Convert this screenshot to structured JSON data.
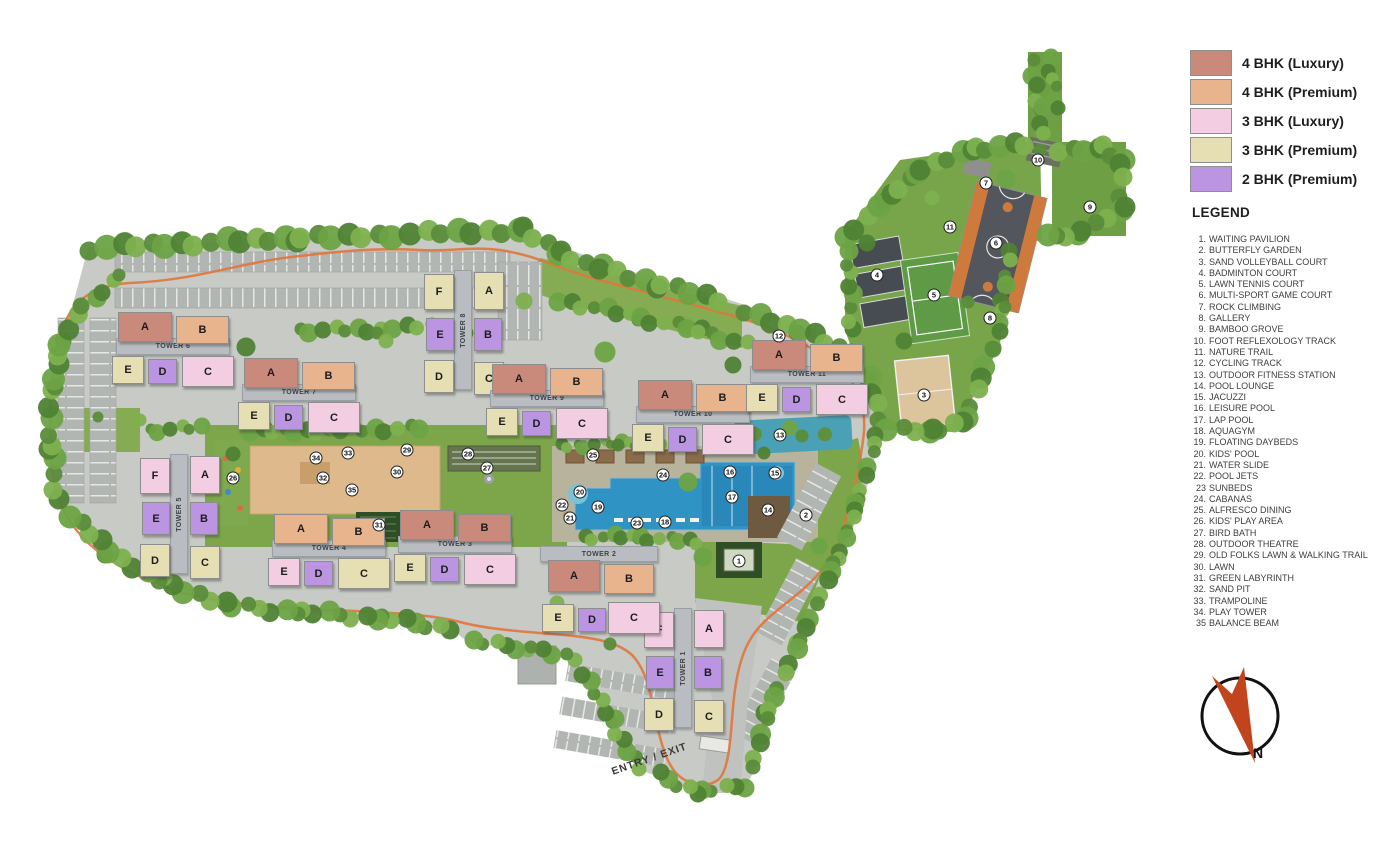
{
  "palette": {
    "4L": "#c98a7b",
    "4P": "#e8b48e",
    "3L": "#f3cde1",
    "3P": "#e5dfb3",
    "2P": "#bb95e2",
    "accent_trail": "#e0763c",
    "compass_needle": "#c2441c"
  },
  "key": {
    "items": [
      {
        "label": "4 BHK (Luxury)",
        "type": "4L"
      },
      {
        "label": "4 BHK (Premium)",
        "type": "4P"
      },
      {
        "label": "3 BHK (Luxury)",
        "type": "3L"
      },
      {
        "label": "3 BHK (Premium)",
        "type": "3P"
      },
      {
        "label": "2 BHK (Premium)",
        "type": "2P"
      }
    ]
  },
  "legend": {
    "title": "LEGEND",
    "items": [
      {
        "n": "1.",
        "label": "WAITING PAVILION"
      },
      {
        "n": "2.",
        "label": "BUTTERFLY GARDEN"
      },
      {
        "n": "3.",
        "label": "SAND VOLLEYBALL COURT"
      },
      {
        "n": "4.",
        "label": "BADMINTON COURT"
      },
      {
        "n": "5.",
        "label": "LAWN TENNIS COURT"
      },
      {
        "n": "6.",
        "label": "MULTI-SPORT GAME COURT"
      },
      {
        "n": "7.",
        "label": "ROCK CLIMBING"
      },
      {
        "n": "8.",
        "label": "GALLERY"
      },
      {
        "n": "9.",
        "label": "BAMBOO GROVE"
      },
      {
        "n": "10.",
        "label": "FOOT REFLEXOLOGY TRACK"
      },
      {
        "n": "11.",
        "label": "NATURE TRAIL"
      },
      {
        "n": "12.",
        "label": "CYCLING TRACK"
      },
      {
        "n": "13.",
        "label": "OUTDOOR FITNESS STATION"
      },
      {
        "n": "14.",
        "label": "POOL LOUNGE"
      },
      {
        "n": "15.",
        "label": "JACUZZI"
      },
      {
        "n": "16.",
        "label": "LEISURE POOL"
      },
      {
        "n": "17.",
        "label": "LAP POOL"
      },
      {
        "n": "18.",
        "label": "AQUAGYM"
      },
      {
        "n": "19.",
        "label": "FLOATING DAYBEDS"
      },
      {
        "n": "20.",
        "label": "KIDS' POOL"
      },
      {
        "n": "21.",
        "label": "WATER SLIDE"
      },
      {
        "n": "22.",
        "label": "POOL JETS"
      },
      {
        "n": "23",
        "label": "SUNBEDS"
      },
      {
        "n": "24.",
        "label": "CABANAS"
      },
      {
        "n": "25.",
        "label": "ALFRESCO DINING"
      },
      {
        "n": "26.",
        "label": "KIDS' PLAY AREA"
      },
      {
        "n": "27.",
        "label": "BIRD BATH"
      },
      {
        "n": "28.",
        "label": "OUTDOOR THEATRE"
      },
      {
        "n": "29.",
        "label": "OLD FOLKS LAWN & WALKING TRAIL"
      },
      {
        "n": "30.",
        "label": "LAWN"
      },
      {
        "n": "31.",
        "label": "GREEN LABYRINTH"
      },
      {
        "n": "32.",
        "label": "SAND PIT"
      },
      {
        "n": "33.",
        "label": "TRAMPOLINE"
      },
      {
        "n": "34.",
        "label": "PLAY TOWER"
      },
      {
        "n": "35",
        "label": "BALANCE BEAM"
      }
    ]
  },
  "towers": [
    {
      "name": "TOWER 1",
      "kind": "v",
      "x": 644,
      "y": 606,
      "blocks": [
        {
          "letter": "F",
          "type": "3L"
        },
        {
          "letter": "A",
          "type": "3L"
        },
        {
          "letter": "E",
          "type": "2P"
        },
        {
          "letter": "B",
          "type": "2P"
        },
        {
          "letter": "D",
          "type": "3P"
        },
        {
          "letter": "C",
          "type": "3P"
        }
      ]
    },
    {
      "name": "TOWER 2",
      "kind": "ht",
      "x": 540,
      "y": 546,
      "blocks": [
        {
          "letter": "A",
          "type": "4L"
        },
        {
          "letter": "B",
          "type": "4P"
        },
        {
          "letter": "E",
          "type": "3P"
        },
        {
          "letter": "D",
          "type": "2P"
        },
        {
          "letter": "C",
          "type": "3L"
        }
      ]
    },
    {
      "name": "TOWER 3",
      "kind": "h",
      "x": 394,
      "y": 510,
      "blocks": [
        {
          "letter": "A",
          "type": "4L"
        },
        {
          "letter": "B",
          "type": "4L"
        },
        {
          "letter": "E",
          "type": "3P"
        },
        {
          "letter": "D",
          "type": "2P"
        },
        {
          "letter": "C",
          "type": "3L"
        }
      ]
    },
    {
      "name": "TOWER 4",
      "kind": "h",
      "x": 268,
      "y": 514,
      "blocks": [
        {
          "letter": "A",
          "type": "4P"
        },
        {
          "letter": "B",
          "type": "4P"
        },
        {
          "letter": "E",
          "type": "3L"
        },
        {
          "letter": "D",
          "type": "2P"
        },
        {
          "letter": "C",
          "type": "3P"
        }
      ]
    },
    {
      "name": "TOWER 5",
      "kind": "v",
      "x": 140,
      "y": 452,
      "blocks": [
        {
          "letter": "F",
          "type": "3L"
        },
        {
          "letter": "A",
          "type": "3L"
        },
        {
          "letter": "E",
          "type": "2P"
        },
        {
          "letter": "B",
          "type": "2P"
        },
        {
          "letter": "D",
          "type": "3P"
        },
        {
          "letter": "C",
          "type": "3P"
        }
      ]
    },
    {
      "name": "TOWER 6",
      "kind": "h",
      "x": 112,
      "y": 312,
      "blocks": [
        {
          "letter": "A",
          "type": "4L"
        },
        {
          "letter": "B",
          "type": "4P"
        },
        {
          "letter": "E",
          "type": "3P"
        },
        {
          "letter": "D",
          "type": "2P"
        },
        {
          "letter": "C",
          "type": "3L"
        }
      ]
    },
    {
      "name": "TOWER 7",
      "kind": "h",
      "x": 238,
      "y": 358,
      "blocks": [
        {
          "letter": "A",
          "type": "4L"
        },
        {
          "letter": "B",
          "type": "4P"
        },
        {
          "letter": "E",
          "type": "3P"
        },
        {
          "letter": "D",
          "type": "2P"
        },
        {
          "letter": "C",
          "type": "3L"
        }
      ]
    },
    {
      "name": "TOWER 8",
      "kind": "v",
      "x": 424,
      "y": 268,
      "blocks": [
        {
          "letter": "F",
          "type": "3P"
        },
        {
          "letter": "A",
          "type": "3P"
        },
        {
          "letter": "E",
          "type": "2P"
        },
        {
          "letter": "B",
          "type": "2P"
        },
        {
          "letter": "D",
          "type": "3P"
        },
        {
          "letter": "C",
          "type": "3P"
        }
      ]
    },
    {
      "name": "TOWER 9",
      "kind": "h",
      "x": 486,
      "y": 364,
      "blocks": [
        {
          "letter": "A",
          "type": "4L"
        },
        {
          "letter": "B",
          "type": "4P"
        },
        {
          "letter": "E",
          "type": "3P"
        },
        {
          "letter": "D",
          "type": "2P"
        },
        {
          "letter": "C",
          "type": "3L"
        }
      ]
    },
    {
      "name": "TOWER 10",
      "kind": "h",
      "x": 632,
      "y": 380,
      "blocks": [
        {
          "letter": "A",
          "type": "4L"
        },
        {
          "letter": "B",
          "type": "4P"
        },
        {
          "letter": "E",
          "type": "3P"
        },
        {
          "letter": "D",
          "type": "2P"
        },
        {
          "letter": "C",
          "type": "3L"
        }
      ]
    },
    {
      "name": "TOWER 11",
      "kind": "h",
      "x": 746,
      "y": 340,
      "blocks": [
        {
          "letter": "A",
          "type": "4L"
        },
        {
          "letter": "B",
          "type": "4P"
        },
        {
          "letter": "E",
          "type": "3P"
        },
        {
          "letter": "D",
          "type": "2P"
        },
        {
          "letter": "C",
          "type": "3L"
        }
      ]
    }
  ],
  "markers": [
    {
      "n": "1",
      "x": 739,
      "y": 561
    },
    {
      "n": "2",
      "x": 806,
      "y": 515
    },
    {
      "n": "3",
      "x": 924,
      "y": 395
    },
    {
      "n": "4",
      "x": 877,
      "y": 275
    },
    {
      "n": "5",
      "x": 934,
      "y": 295
    },
    {
      "n": "6",
      "x": 996,
      "y": 243
    },
    {
      "n": "7",
      "x": 986,
      "y": 183
    },
    {
      "n": "8",
      "x": 990,
      "y": 318
    },
    {
      "n": "9",
      "x": 1090,
      "y": 207
    },
    {
      "n": "10",
      "x": 1038,
      "y": 160
    },
    {
      "n": "11",
      "x": 950,
      "y": 227
    },
    {
      "n": "12",
      "x": 779,
      "y": 336
    },
    {
      "n": "13",
      "x": 780,
      "y": 435
    },
    {
      "n": "14",
      "x": 768,
      "y": 510
    },
    {
      "n": "15",
      "x": 775,
      "y": 473
    },
    {
      "n": "16",
      "x": 730,
      "y": 472
    },
    {
      "n": "17",
      "x": 732,
      "y": 497
    },
    {
      "n": "18",
      "x": 665,
      "y": 522
    },
    {
      "n": "19",
      "x": 598,
      "y": 507
    },
    {
      "n": "20",
      "x": 580,
      "y": 492
    },
    {
      "n": "21",
      "x": 570,
      "y": 518
    },
    {
      "n": "22",
      "x": 562,
      "y": 505
    },
    {
      "n": "23",
      "x": 637,
      "y": 523
    },
    {
      "n": "24",
      "x": 663,
      "y": 475
    },
    {
      "n": "25",
      "x": 593,
      "y": 455
    },
    {
      "n": "26",
      "x": 233,
      "y": 478
    },
    {
      "n": "27",
      "x": 487,
      "y": 468
    },
    {
      "n": "28",
      "x": 468,
      "y": 454
    },
    {
      "n": "29",
      "x": 407,
      "y": 450
    },
    {
      "n": "30",
      "x": 397,
      "y": 472
    },
    {
      "n": "31",
      "x": 379,
      "y": 525
    },
    {
      "n": "32",
      "x": 323,
      "y": 478
    },
    {
      "n": "33",
      "x": 348,
      "y": 453
    },
    {
      "n": "34",
      "x": 316,
      "y": 458
    },
    {
      "n": "35",
      "x": 352,
      "y": 490
    }
  ],
  "entry": {
    "label": "ENTRY / EXIT"
  },
  "compass": {
    "label": "N"
  }
}
